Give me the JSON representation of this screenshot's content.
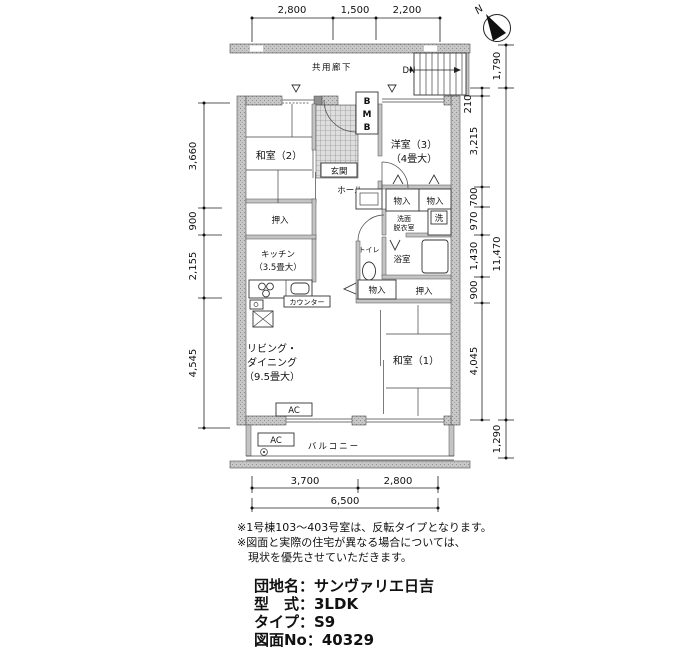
{
  "compass": {
    "north": "N"
  },
  "corridor": {
    "label": "共用廊下",
    "down": "DN"
  },
  "meter_box": [
    "B",
    "M",
    "B"
  ],
  "rooms": {
    "washitsu2": "和室（2）",
    "genkan": "玄関",
    "yoshitsu3_name": "洋室（3）",
    "yoshitsu3_size": "（4畳大）",
    "hall": "ホール",
    "oshiire_upper": "押入",
    "monoire_a": "物入",
    "monoire_b": "物入",
    "senmen_1": "洗面",
    "senmen_2": "脱衣室",
    "washer": "洗",
    "toilet": "トイレ",
    "bath": "浴室",
    "kitchen_name": "キッチン",
    "kitchen_size": "（3.5畳大）",
    "counter": "カウンター",
    "monoire_c": "物入",
    "oshiire_lower": "押入",
    "living_1": "リビング・",
    "living_2": "ダイニング",
    "living_3": "（9.5畳大）",
    "washitsu1": "和室（1）",
    "balcony": "バルコニー",
    "ac_living": "AC",
    "ac_balcony": "AC"
  },
  "dimensions": {
    "top": [
      "2,800",
      "1,500",
      "2,200"
    ],
    "left": [
      "3,660",
      "900",
      "2,155",
      "4,545"
    ],
    "right_inner": [
      "210",
      "3,215",
      "700",
      "970",
      "1,430",
      "900",
      "4,045"
    ],
    "right_outer": [
      "1,790",
      "11,470",
      "1,290"
    ],
    "bottom": [
      "3,700",
      "2,800"
    ],
    "bottom_total": "6,500"
  },
  "notes": [
    "※1号棟103〜403号室は、反転タイプとなります。",
    "※図面と実際の住宅が異なる場合については、",
    "　現状を優先させていただきます。"
  ],
  "info": [
    "団地名：サンヴァリエ日吉",
    "型　式：3LDK",
    "タイプ：S9",
    "図面No：40329"
  ]
}
